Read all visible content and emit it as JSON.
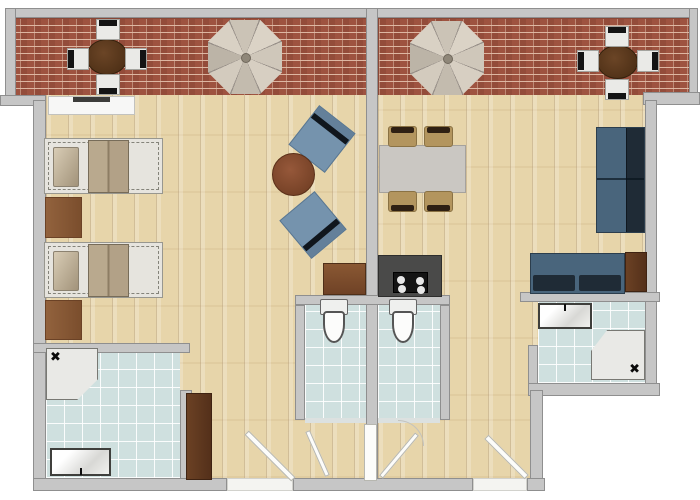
{
  "palette": {
    "wall": "#c6c6c6",
    "wallline": "#8f8f8f",
    "brick": "#9e5340",
    "wood": "#e7d5aa",
    "tile": "#cfe0df",
    "navy": "#1f2b36",
    "slate": "#49657c",
    "chairblue": "#7593ad",
    "tan": "#b3955e",
    "bedframe": "#e6e4de"
  },
  "floorplan": {
    "canvas": {
      "width": 700,
      "height": 500
    },
    "items": [
      {
        "name": "terrace-left-floor",
        "type": "brick",
        "x": 5,
        "y": 18,
        "w": 363,
        "h": 79
      },
      {
        "name": "terrace-right-floor",
        "type": "brick",
        "x": 378,
        "y": 18,
        "w": 319,
        "h": 79
      },
      {
        "name": "left-apartment-floor",
        "type": "wood",
        "x": 46,
        "y": 95,
        "w": 320,
        "h": 383
      },
      {
        "name": "right-apartment-floor",
        "type": "wood",
        "x": 378,
        "y": 95,
        "w": 267,
        "h": 301
      },
      {
        "name": "right-corridor-floor",
        "type": "wood",
        "x": 378,
        "y": 396,
        "w": 165,
        "h": 82
      },
      {
        "name": "left-bathroom-floor",
        "type": "tile",
        "x": 46,
        "y": 353,
        "w": 134,
        "h": 125
      },
      {
        "name": "left-wc-floor",
        "type": "tile",
        "x": 305,
        "y": 305,
        "w": 61,
        "h": 115
      },
      {
        "name": "right-wc-floor",
        "type": "tile",
        "x": 378,
        "y": 305,
        "w": 62,
        "h": 115
      },
      {
        "name": "right-bathroom-floor",
        "type": "tile",
        "x": 538,
        "y": 302,
        "w": 107,
        "h": 81
      },
      {
        "name": "wall-top",
        "type": "wall",
        "x": 5,
        "y": 8,
        "w": 692,
        "h": 10
      },
      {
        "name": "wall-terrace-left",
        "type": "wall",
        "x": 5,
        "y": 8,
        "w": 11,
        "h": 97
      },
      {
        "name": "wall-terrace-right",
        "type": "wall",
        "x": 689,
        "y": 8,
        "w": 9,
        "h": 92
      },
      {
        "name": "wall-divider",
        "type": "wall",
        "x": 366,
        "y": 8,
        "w": 12,
        "h": 483
      },
      {
        "name": "wall-step-left",
        "type": "wall",
        "x": 0,
        "y": 95,
        "w": 46,
        "h": 11
      },
      {
        "name": "wall-left",
        "type": "wall",
        "x": 33,
        "y": 100,
        "w": 13,
        "h": 391
      },
      {
        "name": "wall-step-right",
        "type": "wall",
        "x": 643,
        "y": 92,
        "w": 57,
        "h": 13
      },
      {
        "name": "wall-right",
        "type": "wall",
        "x": 645,
        "y": 100,
        "w": 12,
        "h": 296
      },
      {
        "name": "wall-left-bathroom-top",
        "type": "wall",
        "x": 33,
        "y": 343,
        "w": 157,
        "h": 10
      },
      {
        "name": "wall-left-bathroom-right",
        "type": "wall",
        "x": 180,
        "y": 390,
        "w": 12,
        "h": 91
      },
      {
        "name": "wall-wc-top",
        "type": "wall",
        "x": 295,
        "y": 295,
        "w": 155,
        "h": 10
      },
      {
        "name": "wall-wc-left",
        "type": "wall",
        "x": 295,
        "y": 305,
        "w": 10,
        "h": 115
      },
      {
        "name": "wall-wc-right",
        "type": "wall",
        "x": 440,
        "y": 305,
        "w": 10,
        "h": 115
      },
      {
        "name": "wall-right-bathroom-top",
        "type": "wall",
        "x": 520,
        "y": 292,
        "w": 140,
        "h": 10
      },
      {
        "name": "wall-right-bathroom-left",
        "type": "wall",
        "x": 528,
        "y": 345,
        "w": 10,
        "h": 48
      },
      {
        "name": "wall-right-bathroom-bottom",
        "type": "wall",
        "x": 528,
        "y": 383,
        "w": 132,
        "h": 13
      },
      {
        "name": "wall-corridor-right",
        "type": "wall",
        "x": 530,
        "y": 390,
        "w": 13,
        "h": 101
      },
      {
        "name": "wall-bottom-left",
        "type": "wall",
        "x": 33,
        "y": 478,
        "w": 194,
        "h": 13
      },
      {
        "name": "wall-bottom-middle",
        "type": "wall",
        "x": 293,
        "y": 478,
        "w": 180,
        "h": 13
      },
      {
        "name": "wall-bottom-right",
        "type": "wall",
        "x": 527,
        "y": 478,
        "w": 18,
        "h": 13
      },
      {
        "name": "left-entry-threshold",
        "type": "threshold",
        "x": 227,
        "y": 478,
        "w": 66,
        "h": 13
      },
      {
        "name": "right-entry-threshold",
        "type": "threshold",
        "x": 473,
        "y": 478,
        "w": 54,
        "h": 13
      },
      {
        "name": "left-wc-sill",
        "type": "sill",
        "x": 305,
        "y": 418,
        "w": 61,
        "h": 5
      },
      {
        "name": "right-wc-sill",
        "type": "sill",
        "x": 378,
        "y": 418,
        "w": 62,
        "h": 5
      },
      {
        "name": "dresser",
        "type": "dresser",
        "x": 48,
        "y": 96,
        "w": 87,
        "h": 19
      },
      {
        "name": "bed-1",
        "type": "bed",
        "x": 44,
        "y": 138,
        "w": 119,
        "h": 56
      },
      {
        "name": "bed-rug-1",
        "type": "rug",
        "x": 45,
        "y": 197,
        "w": 37,
        "h": 41
      },
      {
        "name": "bed-2",
        "type": "bed",
        "x": 44,
        "y": 242,
        "w": 119,
        "h": 56
      },
      {
        "name": "bed-rug-2",
        "type": "rug",
        "x": 45,
        "y": 300,
        "w": 37,
        "h": 40
      },
      {
        "name": "armchair-1",
        "type": "chair-blue",
        "x": 299,
        "y": 114,
        "w": 46,
        "h": 50,
        "rot": 38
      },
      {
        "name": "armchair-2",
        "type": "chair-blue",
        "x": 290,
        "y": 200,
        "w": 46,
        "h": 50,
        "rot": 140
      },
      {
        "name": "coffee-table",
        "type": "round-table",
        "x": 272,
        "y": 153,
        "w": 43,
        "h": 43
      },
      {
        "name": "desk",
        "type": "desk",
        "x": 323,
        "y": 263,
        "w": 43,
        "h": 32
      },
      {
        "name": "wardrobe",
        "type": "wardrobe",
        "x": 186,
        "y": 393,
        "w": 26,
        "h": 87
      },
      {
        "name": "left-shower",
        "type": "shower",
        "variant": "cut-br x-tl",
        "x": 46,
        "y": 348,
        "w": 52,
        "h": 52
      },
      {
        "name": "left-sink",
        "type": "sink",
        "variant": "f-bottom",
        "x": 50,
        "y": 448,
        "w": 61,
        "h": 28
      },
      {
        "name": "left-toilet",
        "type": "toilet",
        "x": 319,
        "y": 299,
        "w": 30,
        "h": 45
      },
      {
        "name": "right-toilet",
        "type": "toilet",
        "x": 388,
        "y": 299,
        "w": 30,
        "h": 45
      },
      {
        "name": "dining-table",
        "type": "dining-table",
        "x": 379,
        "y": 145,
        "w": 87,
        "h": 48
      },
      {
        "name": "dining-chair-1",
        "type": "dining-chair",
        "x": 388,
        "y": 126,
        "w": 29,
        "h": 21
      },
      {
        "name": "dining-chair-2",
        "type": "dining-chair",
        "x": 424,
        "y": 126,
        "w": 29,
        "h": 21
      },
      {
        "name": "dining-chair-3",
        "type": "dining-chair",
        "x": 388,
        "y": 191,
        "w": 29,
        "h": 21,
        "rot": 180
      },
      {
        "name": "dining-chair-4",
        "type": "dining-chair",
        "x": 424,
        "y": 191,
        "w": 29,
        "h": 21,
        "rot": 180
      },
      {
        "name": "kitchen-counter",
        "type": "counter",
        "x": 378,
        "y": 255,
        "w": 64,
        "h": 42
      },
      {
        "name": "cooktop",
        "type": "cooktop",
        "x": 393,
        "y": 272,
        "w": 35,
        "h": 21
      },
      {
        "name": "sofa",
        "type": "sofa-v",
        "x": 596,
        "y": 127,
        "w": 49,
        "h": 106
      },
      {
        "name": "couch",
        "type": "couch-h",
        "x": 530,
        "y": 253,
        "w": 95,
        "h": 41
      },
      {
        "name": "side-unit",
        "type": "side-unit",
        "x": 625,
        "y": 252,
        "w": 22,
        "h": 40
      },
      {
        "name": "right-sink",
        "type": "sink",
        "variant": "f-top",
        "x": 538,
        "y": 303,
        "w": 54,
        "h": 26
      },
      {
        "name": "right-shower",
        "type": "shower",
        "variant": "cut-tl x-br",
        "x": 591,
        "y": 330,
        "w": 54,
        "h": 50
      },
      {
        "name": "patio-table-left",
        "type": "patio-table",
        "x": 86,
        "y": 39,
        "w": 42,
        "h": 36
      },
      {
        "name": "patio-chair-left-top",
        "type": "patio-chair",
        "x": 96,
        "y": 19,
        "w": 24,
        "h": 21
      },
      {
        "name": "patio-chair-left-bottom",
        "type": "patio-chair",
        "x": 96,
        "y": 74,
        "w": 24,
        "h": 21,
        "rot": 180
      },
      {
        "name": "patio-chair-left-left",
        "type": "patio-chair",
        "x": 67,
        "y": 48,
        "w": 22,
        "h": 22,
        "rot": -90
      },
      {
        "name": "patio-chair-left-right",
        "type": "patio-chair",
        "x": 125,
        "y": 48,
        "w": 22,
        "h": 22,
        "rot": 90
      },
      {
        "name": "parasol-left",
        "type": "parasol",
        "x": 208,
        "y": 20,
        "w": 74,
        "h": 74
      },
      {
        "name": "parasol-right",
        "type": "parasol",
        "x": 410,
        "y": 21,
        "w": 74,
        "h": 74
      },
      {
        "name": "patio-table-right",
        "type": "patio-table",
        "x": 597,
        "y": 45,
        "w": 41,
        "h": 34
      },
      {
        "name": "patio-chair-right-top",
        "type": "patio-chair",
        "x": 605,
        "y": 26,
        "w": 24,
        "h": 21
      },
      {
        "name": "patio-chair-right-bottom",
        "type": "patio-chair",
        "x": 605,
        "y": 79,
        "w": 24,
        "h": 21,
        "rot": 180
      },
      {
        "name": "patio-chair-right-left",
        "type": "patio-chair",
        "x": 577,
        "y": 50,
        "w": 22,
        "h": 22,
        "rot": -90
      },
      {
        "name": "patio-chair-right-right",
        "type": "patio-chair",
        "x": 637,
        "y": 50,
        "w": 22,
        "h": 22,
        "rot": 90
      },
      {
        "name": "left-entry-door",
        "type": "door-leaf",
        "x": 237,
        "y": 453,
        "w": 66,
        "h": 6,
        "rot": 45
      },
      {
        "name": "right-entry-door",
        "type": "door-leaf",
        "x": 478,
        "y": 454,
        "w": 57,
        "h": 6,
        "rot": 45
      },
      {
        "name": "left-wc-door",
        "type": "door-leaf",
        "x": 293,
        "y": 451,
        "w": 49,
        "h": 5,
        "rot": 66
      },
      {
        "name": "right-wc-door",
        "type": "door-leaf",
        "x": 371,
        "y": 453,
        "w": 56,
        "h": 5,
        "rot": -50
      },
      {
        "name": "divider-door",
        "type": "door-leaf",
        "x": 364,
        "y": 424,
        "w": 13,
        "h": 57
      },
      {
        "name": "right-wc-door-arc",
        "type": "arc",
        "x": 398,
        "y": 420,
        "w": 26,
        "h": 26
      }
    ]
  }
}
